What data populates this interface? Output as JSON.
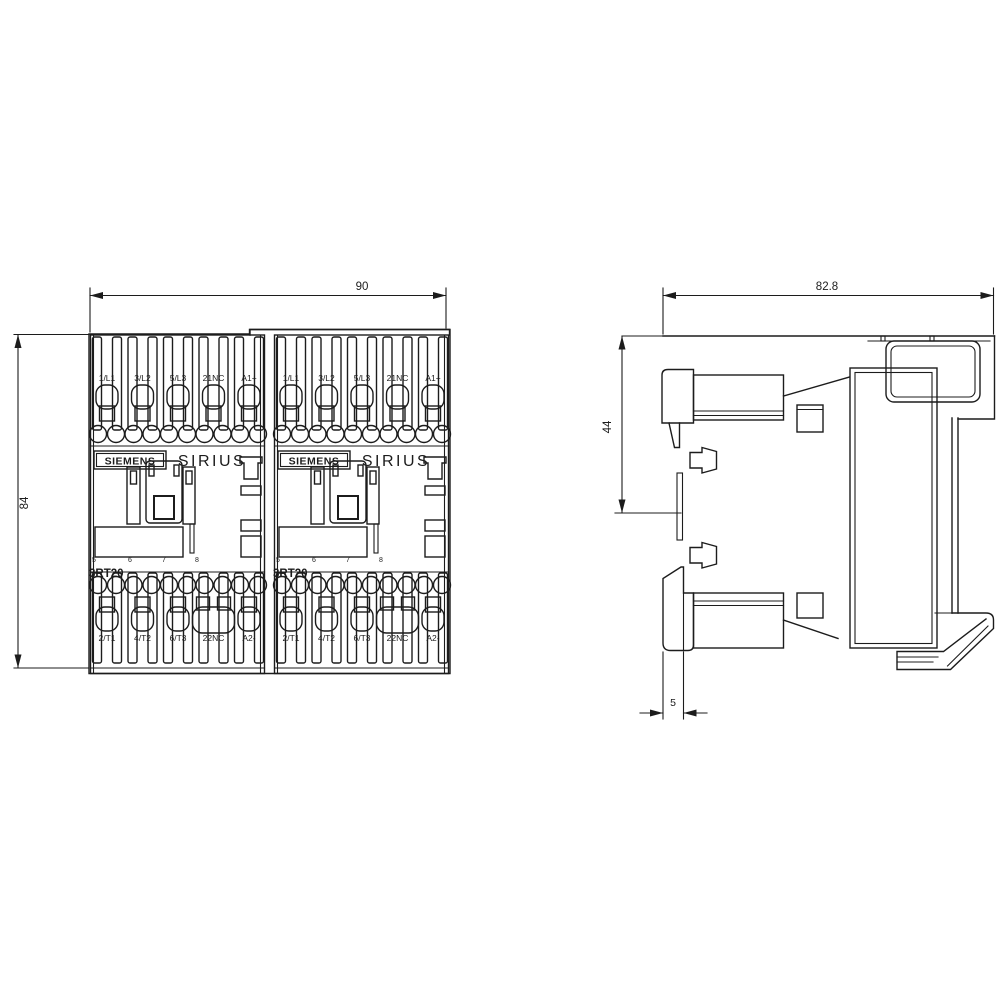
{
  "colors": {
    "background": "#ffffff",
    "line": "#1c1c1c"
  },
  "front_view": {
    "brand": "SIEMENS",
    "series": "SIRIUS",
    "model": "3RT20",
    "top_terminals": [
      "1/L1",
      "3/L2",
      "5/L3",
      "21NC",
      "A1+"
    ],
    "bottom_terminals": [
      "2/T1",
      "4/T2",
      "6/T3",
      "22NC",
      "A2-"
    ],
    "pin_numbers": [
      "5",
      "6",
      "7",
      "8"
    ],
    "dim_width": "90",
    "dim_height": "84"
  },
  "side_view": {
    "dim_depth": "82.8",
    "dim_upper": "44",
    "dim_foot": "5"
  }
}
